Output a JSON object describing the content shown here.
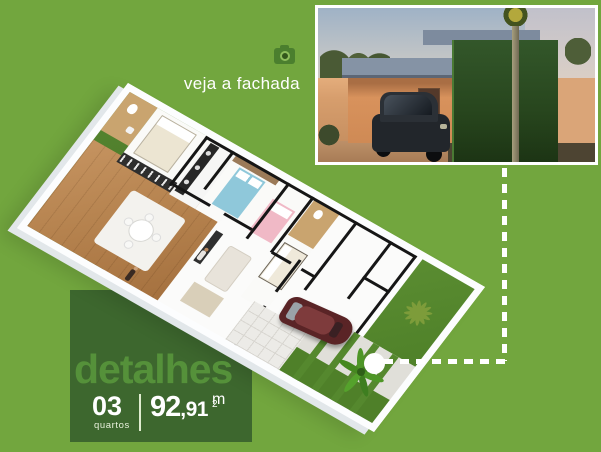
{
  "page": {
    "background_color": "#72a63e",
    "panel_color": "#3d672e",
    "accent_text_color": "#55913a",
    "connector_color": "#ffffff"
  },
  "facade_callout": {
    "icon": "camera-icon",
    "label": "veja a fachada",
    "photo": "house-facade-photo",
    "photo_elements": [
      "dusk-sky",
      "perimeter-wall",
      "flat-roof-house",
      "dark-green-feature-wall",
      "parked-dark-car",
      "palm-trunk",
      "palm-crown",
      "shrubs"
    ]
  },
  "details_panel": {
    "title": "detalhes",
    "bedrooms": {
      "value": "03",
      "label": "quartos"
    },
    "area": {
      "main": "92",
      "decimal": ",91",
      "unit": "m",
      "unit_sup": "2"
    }
  },
  "floor_plan": {
    "type": "isometric-3d-floor-plan",
    "elements": [
      "side-lawn",
      "backyard-lawn-with-palm-motif",
      "wood-deck-living-area",
      "dining-table-with-chairs",
      "kitchen-counter",
      "bathroom",
      "bedroom-white-bed",
      "bedroom-blue-bed",
      "bedroom-pink-bed",
      "suite-bed",
      "tv-panel",
      "sofa",
      "driveway-with-grass-strips",
      "tiled-walkway",
      "dark-red-car",
      "palm-tree",
      "person-figures",
      "planter"
    ]
  },
  "connector": {
    "dot": "connector-dot",
    "style": "dashed-line"
  }
}
